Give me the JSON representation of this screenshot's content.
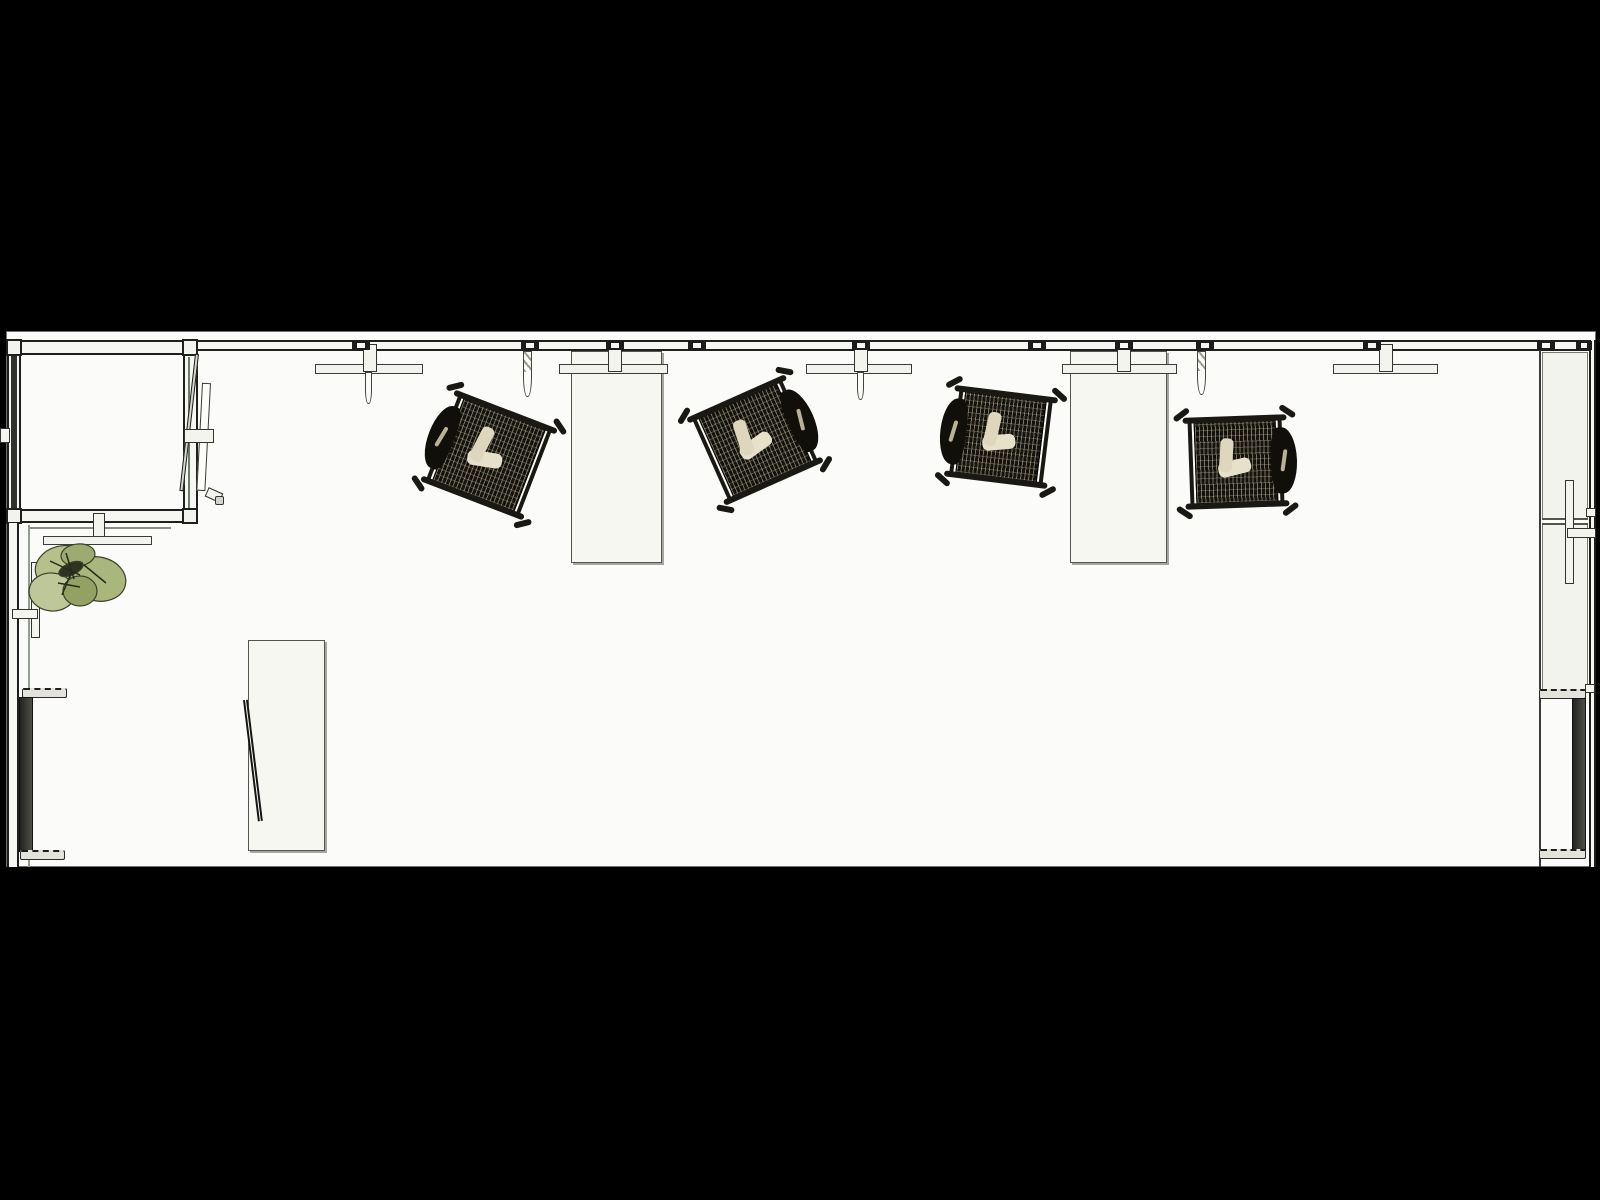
{
  "canvas": {
    "width": 1600,
    "height": 1200,
    "background": "#000000"
  },
  "palette": {
    "floor": "#fbfbf9",
    "wall_fill": "#f6f6f2",
    "line_dark": "#1f1f1d",
    "furniture_fill": "#f7f7f2",
    "chair_frame": "#1a1812",
    "chair_mesh": "#17150f",
    "chair_mesh_light": "#d8cfae",
    "cushion": "#e7e0ca",
    "plant_green": "#b5c08a",
    "plant_dark": "#2f321f",
    "glass_green": "#8ea08e",
    "screen_dark": "#3c3c36"
  },
  "scene": {
    "elements": [
      {
        "type": "floor",
        "name": "floor",
        "x": 6,
        "y": 331,
        "w": 1590,
        "h": 536
      },
      {
        "type": "counter",
        "name": "right-side-counter",
        "x": 1542,
        "y": 352,
        "w": 46,
        "h": 339
      },
      {
        "type": "divider",
        "name": "right-counter-divider",
        "x": 1542,
        "y": 518,
        "w": 46,
        "h": 7
      },
      {
        "type": "desk",
        "name": "desk-1",
        "x": 571,
        "y": 351,
        "w": 91,
        "h": 212
      },
      {
        "type": "desk",
        "name": "desk-2",
        "x": 1070,
        "y": 351,
        "w": 97,
        "h": 212
      },
      {
        "type": "desk",
        "name": "desk-3",
        "x": 248,
        "y": 640,
        "w": 77,
        "h": 211
      },
      {
        "type": "lean-panel",
        "name": "leaning-panel",
        "x": 243,
        "y": 700,
        "w": 5,
        "h": 122,
        "rot": -7,
        "origin": "top center"
      },
      {
        "type": "wall-h",
        "name": "wall-top",
        "x": 182,
        "y": 340,
        "w": 1410,
        "h": 11
      },
      {
        "type": "wall-v",
        "name": "wall-right-outer",
        "x": 1589,
        "y": 340,
        "w": 7,
        "h": 527
      },
      {
        "type": "line-v",
        "name": "wall-right-inner-line",
        "x": 1539,
        "y": 343,
        "w": 2,
        "h": 524,
        "fill": "#3a3a38"
      },
      {
        "type": "wall-v",
        "name": "room-wall-left",
        "x": 7,
        "y": 340,
        "w": 14,
        "h": 183
      },
      {
        "type": "panel-dark",
        "name": "room-left-dark-panel",
        "x": 11,
        "y": 352,
        "w": 6,
        "h": 163
      },
      {
        "type": "wall-v",
        "name": "room-wall-right",
        "x": 183,
        "y": 340,
        "w": 15,
        "h": 183
      },
      {
        "type": "line-v",
        "name": "room-right-glass-line",
        "x": 188,
        "y": 357,
        "w": 2,
        "h": 155,
        "fill": "#6c7a6c"
      },
      {
        "type": "wall-h",
        "name": "room-wall-top",
        "x": 7,
        "y": 340,
        "w": 191,
        "h": 15
      },
      {
        "type": "wall-h",
        "name": "room-wall-bottom",
        "x": 7,
        "y": 509,
        "w": 191,
        "h": 14
      },
      {
        "type": "line-h",
        "name": "room-bottom-outline",
        "x": 28,
        "y": 527,
        "w": 143,
        "h": 2,
        "fill": "#8a8a84"
      },
      {
        "type": "post",
        "name": "wall-post",
        "x": 6,
        "y": 339,
        "w": 16,
        "h": 17
      },
      {
        "type": "post",
        "name": "wall-post",
        "x": 182,
        "y": 339,
        "w": 16,
        "h": 17
      },
      {
        "type": "post",
        "name": "wall-post",
        "x": 6,
        "y": 508,
        "w": 16,
        "h": 16
      },
      {
        "type": "post",
        "name": "wall-post",
        "x": 182,
        "y": 508,
        "w": 16,
        "h": 16
      },
      {
        "type": "door-leaf",
        "name": "door-leaf",
        "x": 195,
        "y": 354,
        "w": 4,
        "h": 138,
        "rot": 6.5,
        "origin": "top center"
      },
      {
        "type": "door-panel",
        "name": "door-panel",
        "x": 202,
        "y": 383,
        "w": 9,
        "h": 108,
        "rot": 3,
        "origin": "top center"
      },
      {
        "type": "bar",
        "name": "door-bracket",
        "x": 184,
        "y": 429,
        "w": 30,
        "h": 14
      },
      {
        "type": "bar",
        "name": "door-stop",
        "x": 206,
        "y": 490,
        "w": 16,
        "h": 10,
        "rot": 24
      },
      {
        "type": "knob",
        "name": "door-knob",
        "x": 215,
        "y": 496,
        "w": 9,
        "h": 9
      },
      {
        "type": "wall-v",
        "name": "wall-left-lower",
        "x": 7,
        "y": 523,
        "w": 12,
        "h": 344
      },
      {
        "type": "line-v",
        "name": "glass-line-left",
        "x": 28,
        "y": 525,
        "w": 2,
        "h": 342,
        "fill": "#8ea08e"
      },
      {
        "type": "bar",
        "name": "left-mullion",
        "x": 31,
        "y": 562,
        "w": 9,
        "h": 76
      },
      {
        "type": "bar",
        "name": "left-tick",
        "x": 12,
        "y": 609,
        "w": 26,
        "h": 10
      },
      {
        "type": "bar",
        "name": "left-wall-tab",
        "x": 0,
        "y": 428,
        "w": 10,
        "h": 15
      },
      {
        "type": "bar",
        "name": "right-wall-tab",
        "x": 1586,
        "y": 508,
        "w": 10,
        "h": 9
      },
      {
        "type": "bar",
        "name": "right-wall-tab",
        "x": 1585,
        "y": 684,
        "w": 10,
        "h": 9
      },
      {
        "type": "bar",
        "name": "plant-shelf-bracket",
        "x": 93,
        "y": 513,
        "w": 12,
        "h": 28
      },
      {
        "type": "shelf",
        "name": "plant-shelf",
        "x": 43,
        "y": 536,
        "w": 109,
        "h": 9
      },
      {
        "type": "shelf",
        "name": "wall-shelf-1",
        "x": 315,
        "y": 364,
        "w": 108,
        "h": 10
      },
      {
        "type": "shelf",
        "name": "wall-shelf-2",
        "x": 806,
        "y": 364,
        "w": 106,
        "h": 10
      },
      {
        "type": "shelf",
        "name": "wall-shelf-3",
        "x": 1333,
        "y": 364,
        "w": 105,
        "h": 10
      },
      {
        "type": "shelf",
        "name": "desk-1-rail",
        "x": 559,
        "y": 364,
        "w": 109,
        "h": 10
      },
      {
        "type": "shelf",
        "name": "desk-2-rail",
        "x": 1062,
        "y": 364,
        "w": 115,
        "h": 10
      },
      {
        "type": "slat",
        "name": "hanging-slat",
        "x": 365,
        "y": 372,
        "w": 7,
        "h": 32
      },
      {
        "type": "slat-hatched",
        "name": "hanging-slat",
        "x": 523,
        "y": 351,
        "w": 9,
        "h": 46
      },
      {
        "type": "slat",
        "name": "hanging-slat",
        "x": 857,
        "y": 372,
        "w": 7,
        "h": 28
      },
      {
        "type": "slat-hatched",
        "name": "hanging-slat",
        "x": 1197,
        "y": 351,
        "w": 9,
        "h": 44
      },
      {
        "type": "bracket",
        "name": "wall-bracket",
        "x": 363,
        "y": 344,
        "w": 14,
        "h": 28
      },
      {
        "type": "bracket",
        "name": "wall-bracket",
        "x": 608,
        "y": 344,
        "w": 14,
        "h": 28
      },
      {
        "type": "bracket",
        "name": "wall-bracket",
        "x": 854,
        "y": 344,
        "w": 14,
        "h": 28
      },
      {
        "type": "bracket",
        "name": "wall-bracket",
        "x": 1117,
        "y": 344,
        "w": 14,
        "h": 28
      },
      {
        "type": "bracket",
        "name": "wall-bracket",
        "x": 1379,
        "y": 344,
        "w": 14,
        "h": 28
      },
      {
        "type": "wall-clamp",
        "name": "wall-clamp",
        "x": 352,
        "y": 341,
        "w": 18,
        "h": 9
      },
      {
        "type": "wall-clamp",
        "name": "wall-clamp",
        "x": 521,
        "y": 341,
        "w": 18,
        "h": 9
      },
      {
        "type": "wall-clamp",
        "name": "wall-clamp",
        "x": 606,
        "y": 341,
        "w": 18,
        "h": 9
      },
      {
        "type": "wall-clamp",
        "name": "wall-clamp",
        "x": 688,
        "y": 341,
        "w": 18,
        "h": 9
      },
      {
        "type": "wall-clamp",
        "name": "wall-clamp",
        "x": 852,
        "y": 341,
        "w": 18,
        "h": 9
      },
      {
        "type": "wall-clamp",
        "name": "wall-clamp",
        "x": 1028,
        "y": 341,
        "w": 18,
        "h": 9
      },
      {
        "type": "wall-clamp",
        "name": "wall-clamp",
        "x": 1115,
        "y": 341,
        "w": 18,
        "h": 9
      },
      {
        "type": "wall-clamp",
        "name": "wall-clamp",
        "x": 1196,
        "y": 341,
        "w": 18,
        "h": 9
      },
      {
        "type": "wall-clamp",
        "name": "wall-clamp",
        "x": 1363,
        "y": 341,
        "w": 18,
        "h": 9
      },
      {
        "type": "wall-clamp",
        "name": "wall-clamp",
        "x": 1537,
        "y": 341,
        "w": 18,
        "h": 9
      },
      {
        "type": "wall-clamp",
        "name": "wall-clamp",
        "x": 1576,
        "y": 341,
        "w": 16,
        "h": 9
      },
      {
        "type": "bar",
        "name": "right-bracket-vertical",
        "x": 1565,
        "y": 480,
        "w": 9,
        "h": 104
      },
      {
        "type": "bar",
        "name": "right-bracket-horizontal",
        "x": 1567,
        "y": 528,
        "w": 29,
        "h": 10
      },
      {
        "type": "tv-foot",
        "name": "display-stand-foot",
        "x": 22,
        "y": 688,
        "w": 45,
        "h": 10
      },
      {
        "type": "tv-screen",
        "name": "display-screen-left",
        "x": 19,
        "y": 697,
        "w": 14,
        "h": 155
      },
      {
        "type": "tv-foot",
        "name": "display-stand-foot",
        "x": 20,
        "y": 850,
        "w": 45,
        "h": 10
      },
      {
        "type": "tv-foot",
        "name": "display-stand-foot",
        "x": 1539,
        "y": 689,
        "w": 47,
        "h": 10
      },
      {
        "type": "tv-screen",
        "name": "display-screen-right",
        "x": 1572,
        "y": 698,
        "w": 14,
        "h": 153
      },
      {
        "type": "tv-foot",
        "name": "display-stand-foot",
        "x": 1539,
        "y": 849,
        "w": 47,
        "h": 10
      },
      {
        "type": "plant",
        "name": "plant",
        "x": 22,
        "y": 535,
        "w": 112,
        "h": 88,
        "blobs": [
          {
            "cx": 40,
            "cy": 32,
            "rx": 27,
            "ry": 21,
            "rot": -15,
            "fill": "#b5c08a"
          },
          {
            "cx": 76,
            "cy": 44,
            "rx": 28,
            "ry": 22,
            "rot": 12,
            "fill": "#a9b77c"
          },
          {
            "cx": 30,
            "cy": 57,
            "rx": 23,
            "ry": 19,
            "rot": 6,
            "fill": "#bec799"
          },
          {
            "cx": 56,
            "cy": 20,
            "rx": 17,
            "ry": 11,
            "rot": -6,
            "fill": "#9dab70"
          },
          {
            "cx": 58,
            "cy": 56,
            "rx": 17,
            "ry": 15,
            "rot": 0,
            "fill": "#93a263"
          },
          {
            "cx": 49,
            "cy": 34,
            "rx": 13,
            "ry": 6,
            "rot": -24,
            "fill": "#2f321f"
          }
        ],
        "veins": [
          [
            28,
            26,
            58,
            40
          ],
          [
            44,
            18,
            52,
            44
          ],
          [
            62,
            30,
            84,
            48
          ],
          [
            36,
            48,
            58,
            52
          ],
          [
            50,
            36,
            40,
            60
          ]
        ]
      },
      {
        "type": "chair",
        "name": "office-chair-1",
        "cx": 489,
        "cy": 455,
        "w": 98,
        "h": 92,
        "rot": 21,
        "head": "left"
      },
      {
        "type": "chair",
        "name": "office-chair-2",
        "cx": 755,
        "cy": 440,
        "w": 96,
        "h": 90,
        "rot": -24,
        "head": "right"
      },
      {
        "type": "chair",
        "name": "office-chair-3",
        "cx": 1001,
        "cy": 437,
        "w": 92,
        "h": 86,
        "rot": 7,
        "head": "left"
      },
      {
        "type": "chair",
        "name": "office-chair-4",
        "cx": 1236,
        "cy": 462,
        "w": 92,
        "h": 86,
        "rot": -2,
        "head": "right"
      }
    ]
  }
}
